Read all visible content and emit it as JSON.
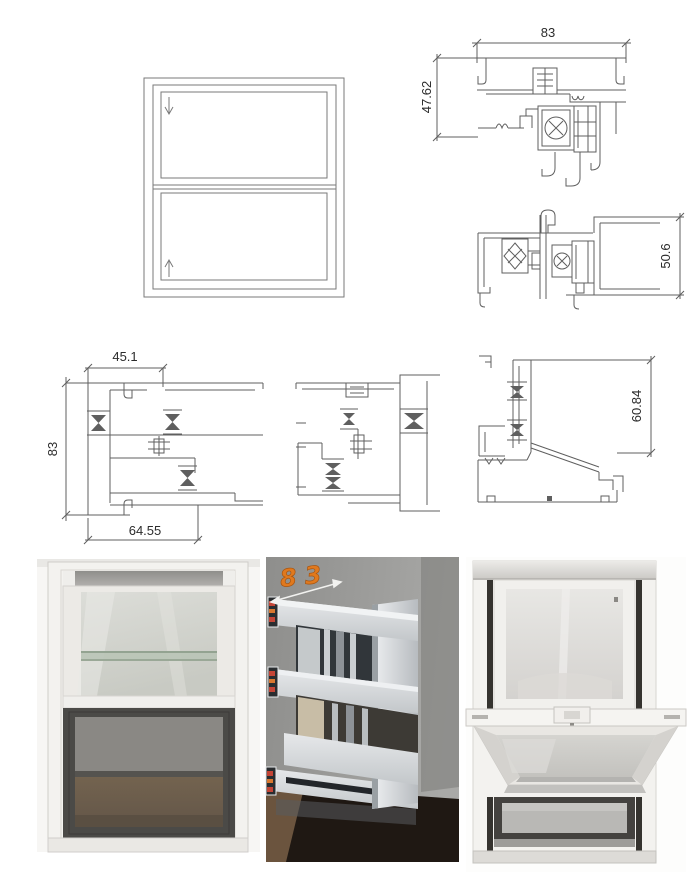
{
  "dims": {
    "head_width": "83",
    "head_height": "47.62",
    "meeting_rail_height": "50.6",
    "jamb_top_width": "45.1",
    "jamb_height": "83",
    "jamb_bottom_width": "64.55",
    "sill_height": "60.84"
  },
  "photo_annotation": {
    "profile_width": "83"
  },
  "colors": {
    "cad_line": "#5f5f5f",
    "dim_text": "#2b2b2b",
    "annotation_orange": "#e0791e",
    "photo_dark_table": "#1f1813",
    "window_white": "#f3f2ef",
    "screen_dark": "#4b4a47"
  }
}
